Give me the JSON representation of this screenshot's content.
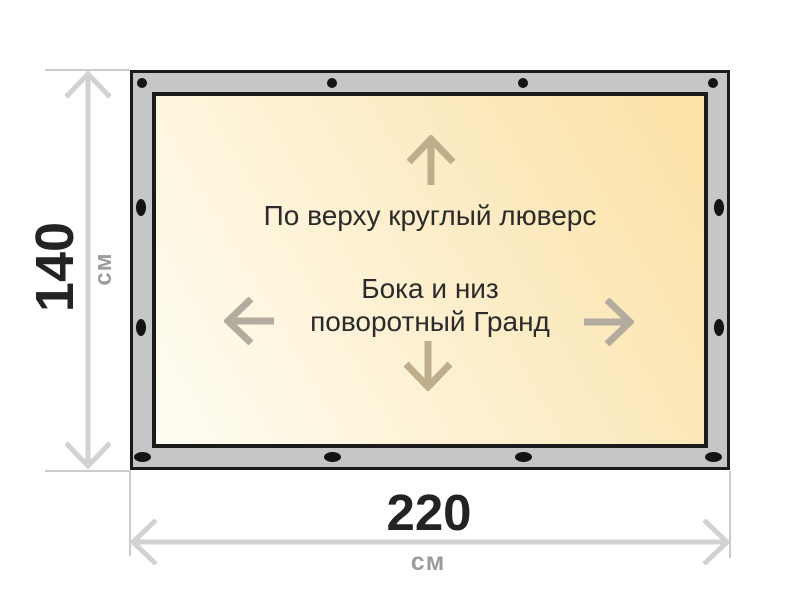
{
  "diagram": {
    "height_dim": {
      "value": "140",
      "unit": "см"
    },
    "width_dim": {
      "value": "220",
      "unit": "см"
    },
    "panel": {
      "top_note": "По верху круглый люверс",
      "center_note_line1": "Бока и низ",
      "center_note_line2": "поворотный Гранд"
    }
  },
  "grommets": {
    "top": {
      "y": 10,
      "x": [
        9,
        199,
        390,
        580
      ],
      "w": 10,
      "h": 10
    },
    "bottom": {
      "y": 384,
      "x": [
        9,
        199,
        390,
        580
      ],
      "w": 17,
      "h": 10
    },
    "left": {
      "x": 8,
      "y": [
        134,
        254
      ],
      "w": 10,
      "h": 17
    },
    "right": {
      "x": 586,
      "y": [
        134,
        254
      ],
      "w": 10,
      "h": 17
    }
  },
  "colors": {
    "frame_fill": "#c4c6c8",
    "frame_border": "#1b1b1b",
    "panel_gradient_start": "#fffdf4",
    "panel_gradient_mid": "#fdf0d0",
    "panel_gradient_end": "#fbe2a8",
    "grommet": "#141414",
    "dimension_line": "#d2d2d2",
    "extension_line": "#cbcbcb",
    "dimension_number": "#232323",
    "unit_text": "#9c9c9c",
    "panel_text": "#2b2b2b",
    "arrow_vertical": "#bfae8c",
    "arrow_horizontal": "#b3ab9d"
  }
}
